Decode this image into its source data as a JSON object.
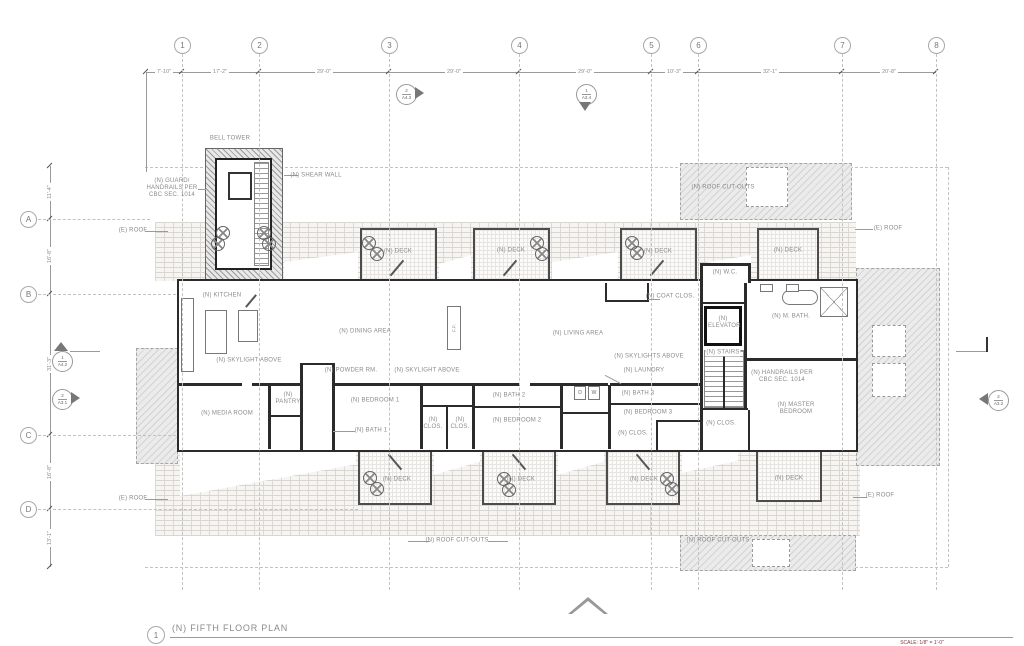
{
  "sheet": {
    "detail_number": "1",
    "title": "(N) FIFTH FLOOR PLAN",
    "scale_note": "SCALE: 1/8\" = 1'-0\""
  },
  "grid": {
    "columns": [
      "1",
      "2",
      "3",
      "4",
      "5",
      "6",
      "7",
      "8"
    ],
    "column_dims": [
      "7'-10\"",
      "17'-2\"",
      "29'-0\"",
      "29'-0\"",
      "29'-0\"",
      "10'-3\"",
      "32'-1\"",
      "20'-8\""
    ],
    "rows": [
      "A",
      "B",
      "C",
      "D"
    ],
    "row_dims": [
      "11'-4\"",
      "16'-8\"",
      "31'-3\"",
      "16'-8\"",
      "13'-1\""
    ]
  },
  "markers": {
    "a43": {
      "num": "2",
      "sheet": "A4.3"
    },
    "a34_top": {
      "num": "1",
      "sheet": "A3.4"
    },
    "a42": {
      "num": "1",
      "sheet": "A4.2"
    },
    "a31": {
      "num": "2",
      "sheet": "A3.1"
    },
    "a32": {
      "num": "2",
      "sheet": "A3.2"
    },
    "a34_bottom": {
      "num": "1",
      "sheet": "A3.4"
    }
  },
  "labels": {
    "bell_tower": "BELL TOWER",
    "guard_handrails": "(N) GUARD/ HANDRAILS PER CBC SEC. 1014",
    "shear_wall": "(N) SHEAR WALL",
    "roof_cutouts": "(N) ROOF CUT-OUTS",
    "existing_roof": "(E) ROOF",
    "deck": "(N) DECK",
    "kitchen": "(N) KITCHEN",
    "dining_area": "(N) DINING AREA",
    "living_area": "(N) LIVING AREA",
    "coat_closet": "(N) COAT CLOS.",
    "wc": "(N) W.C.",
    "master_bath": "(N) M. BATH.",
    "elevator": "(N) ELEVATOR",
    "stairs": "(N) STAIRS",
    "handrails": "(N) HANDRAILS PER CBC SEC. 1014",
    "master_bedroom": "(N) MASTER BEDROOM",
    "closet": "(N) CLOS.",
    "skylight_above": "(N) SKYLIGHT ABOVE",
    "skylights_above": "(N) SKYLIGHTS ABOVE",
    "laundry": "(N) LAUNDRY",
    "powder_room": "(N) POWDER RM.",
    "media_room": "(N) MEDIA ROOM",
    "pantry": "(N) PANTRY",
    "bedroom1": "(N) BEDROOM 1",
    "bath1": "(N) BATH 1",
    "bedroom2": "(N) BEDROOM 2",
    "bath2": "(N) BATH 2",
    "bedroom3": "(N) BEDROOM 3",
    "bath3": "(N) BATH 3",
    "fireplace": "F.P.",
    "dryer": "D",
    "washer": "W"
  }
}
